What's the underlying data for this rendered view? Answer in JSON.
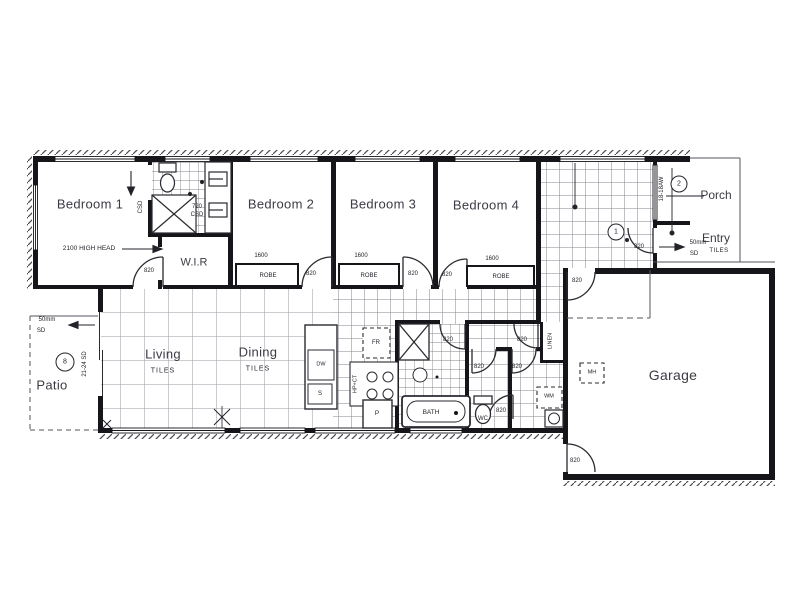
{
  "rooms": {
    "bedroom1": "Bedroom 1",
    "bedroom2": "Bedroom 2",
    "bedroom3": "Bedroom 3",
    "bedroom4": "Bedroom 4",
    "wir": "W.I.R",
    "living": "Living",
    "dining": "Dining",
    "garage": "Garage",
    "patio": "Patio",
    "porch": "Porch",
    "entry": "Entry",
    "bath": "BATH",
    "wc": "WC",
    "linen": "LINEN"
  },
  "floor": {
    "tiles": "TILES"
  },
  "doors": {
    "standard": "820",
    "head_note": "2100 HIGH HEAD",
    "csd_width": "720",
    "csd": "CSD",
    "sliding_code": "21-24 SD",
    "window_code": "18-18AW",
    "step_mm": "50mm",
    "step_sd": "SD"
  },
  "robes": {
    "width": "1600",
    "label": "ROBE"
  },
  "fixtures": {
    "wm": "WM",
    "mh": "MH",
    "fr": "FR",
    "dw": "DW",
    "sink": "S",
    "pantry": "P",
    "cooktop": "HP+CT"
  },
  "markers": {
    "one": "1",
    "two": "2",
    "eight": "8"
  }
}
